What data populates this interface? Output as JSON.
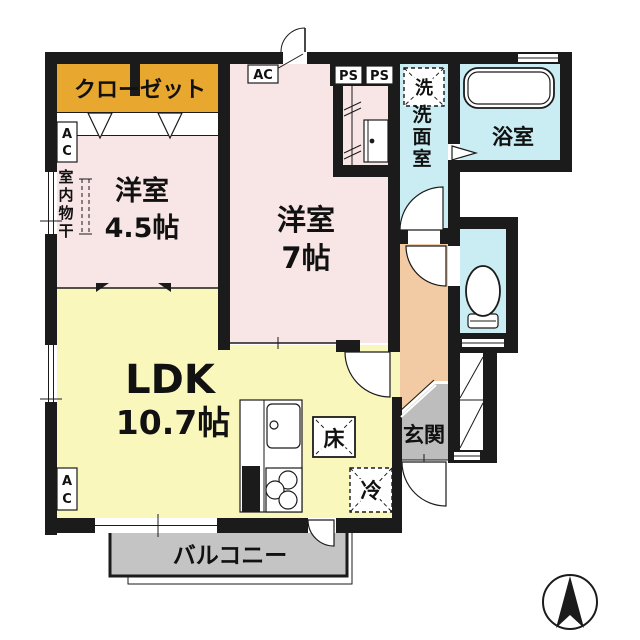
{
  "plan_title": "1LDK apartment floor plan",
  "colors": {
    "wall": "#1B1B1B",
    "closet": "#E8A72E",
    "bedroom": "#F8E6E6",
    "ldk": "#FAF7BD",
    "wet_area": "#C9EDF2",
    "hallway": "#F2CBA4",
    "entrance": "#BDBDBD",
    "balcony": "#C4C4C4"
  },
  "rooms": {
    "closet": {
      "label": "クローゼット"
    },
    "bedroom_4_5": {
      "label": "洋室",
      "size": "4.5帖"
    },
    "bedroom_7": {
      "label": "洋室",
      "size": "7帖"
    },
    "ldk": {
      "label": "LDK",
      "size": "10.7帖"
    },
    "washroom": {
      "label": "洗面室"
    },
    "bathroom": {
      "label": "浴室"
    },
    "entrance": {
      "label": "玄関"
    },
    "balcony": {
      "label": "バルコニー"
    }
  },
  "equipment": {
    "washing_machine": "洗",
    "refrigerator": "冷",
    "floor_storage": "床",
    "indoor_laundry_pole": "室内物干",
    "air_conditioner": "AC",
    "pipe_space": "PS"
  }
}
